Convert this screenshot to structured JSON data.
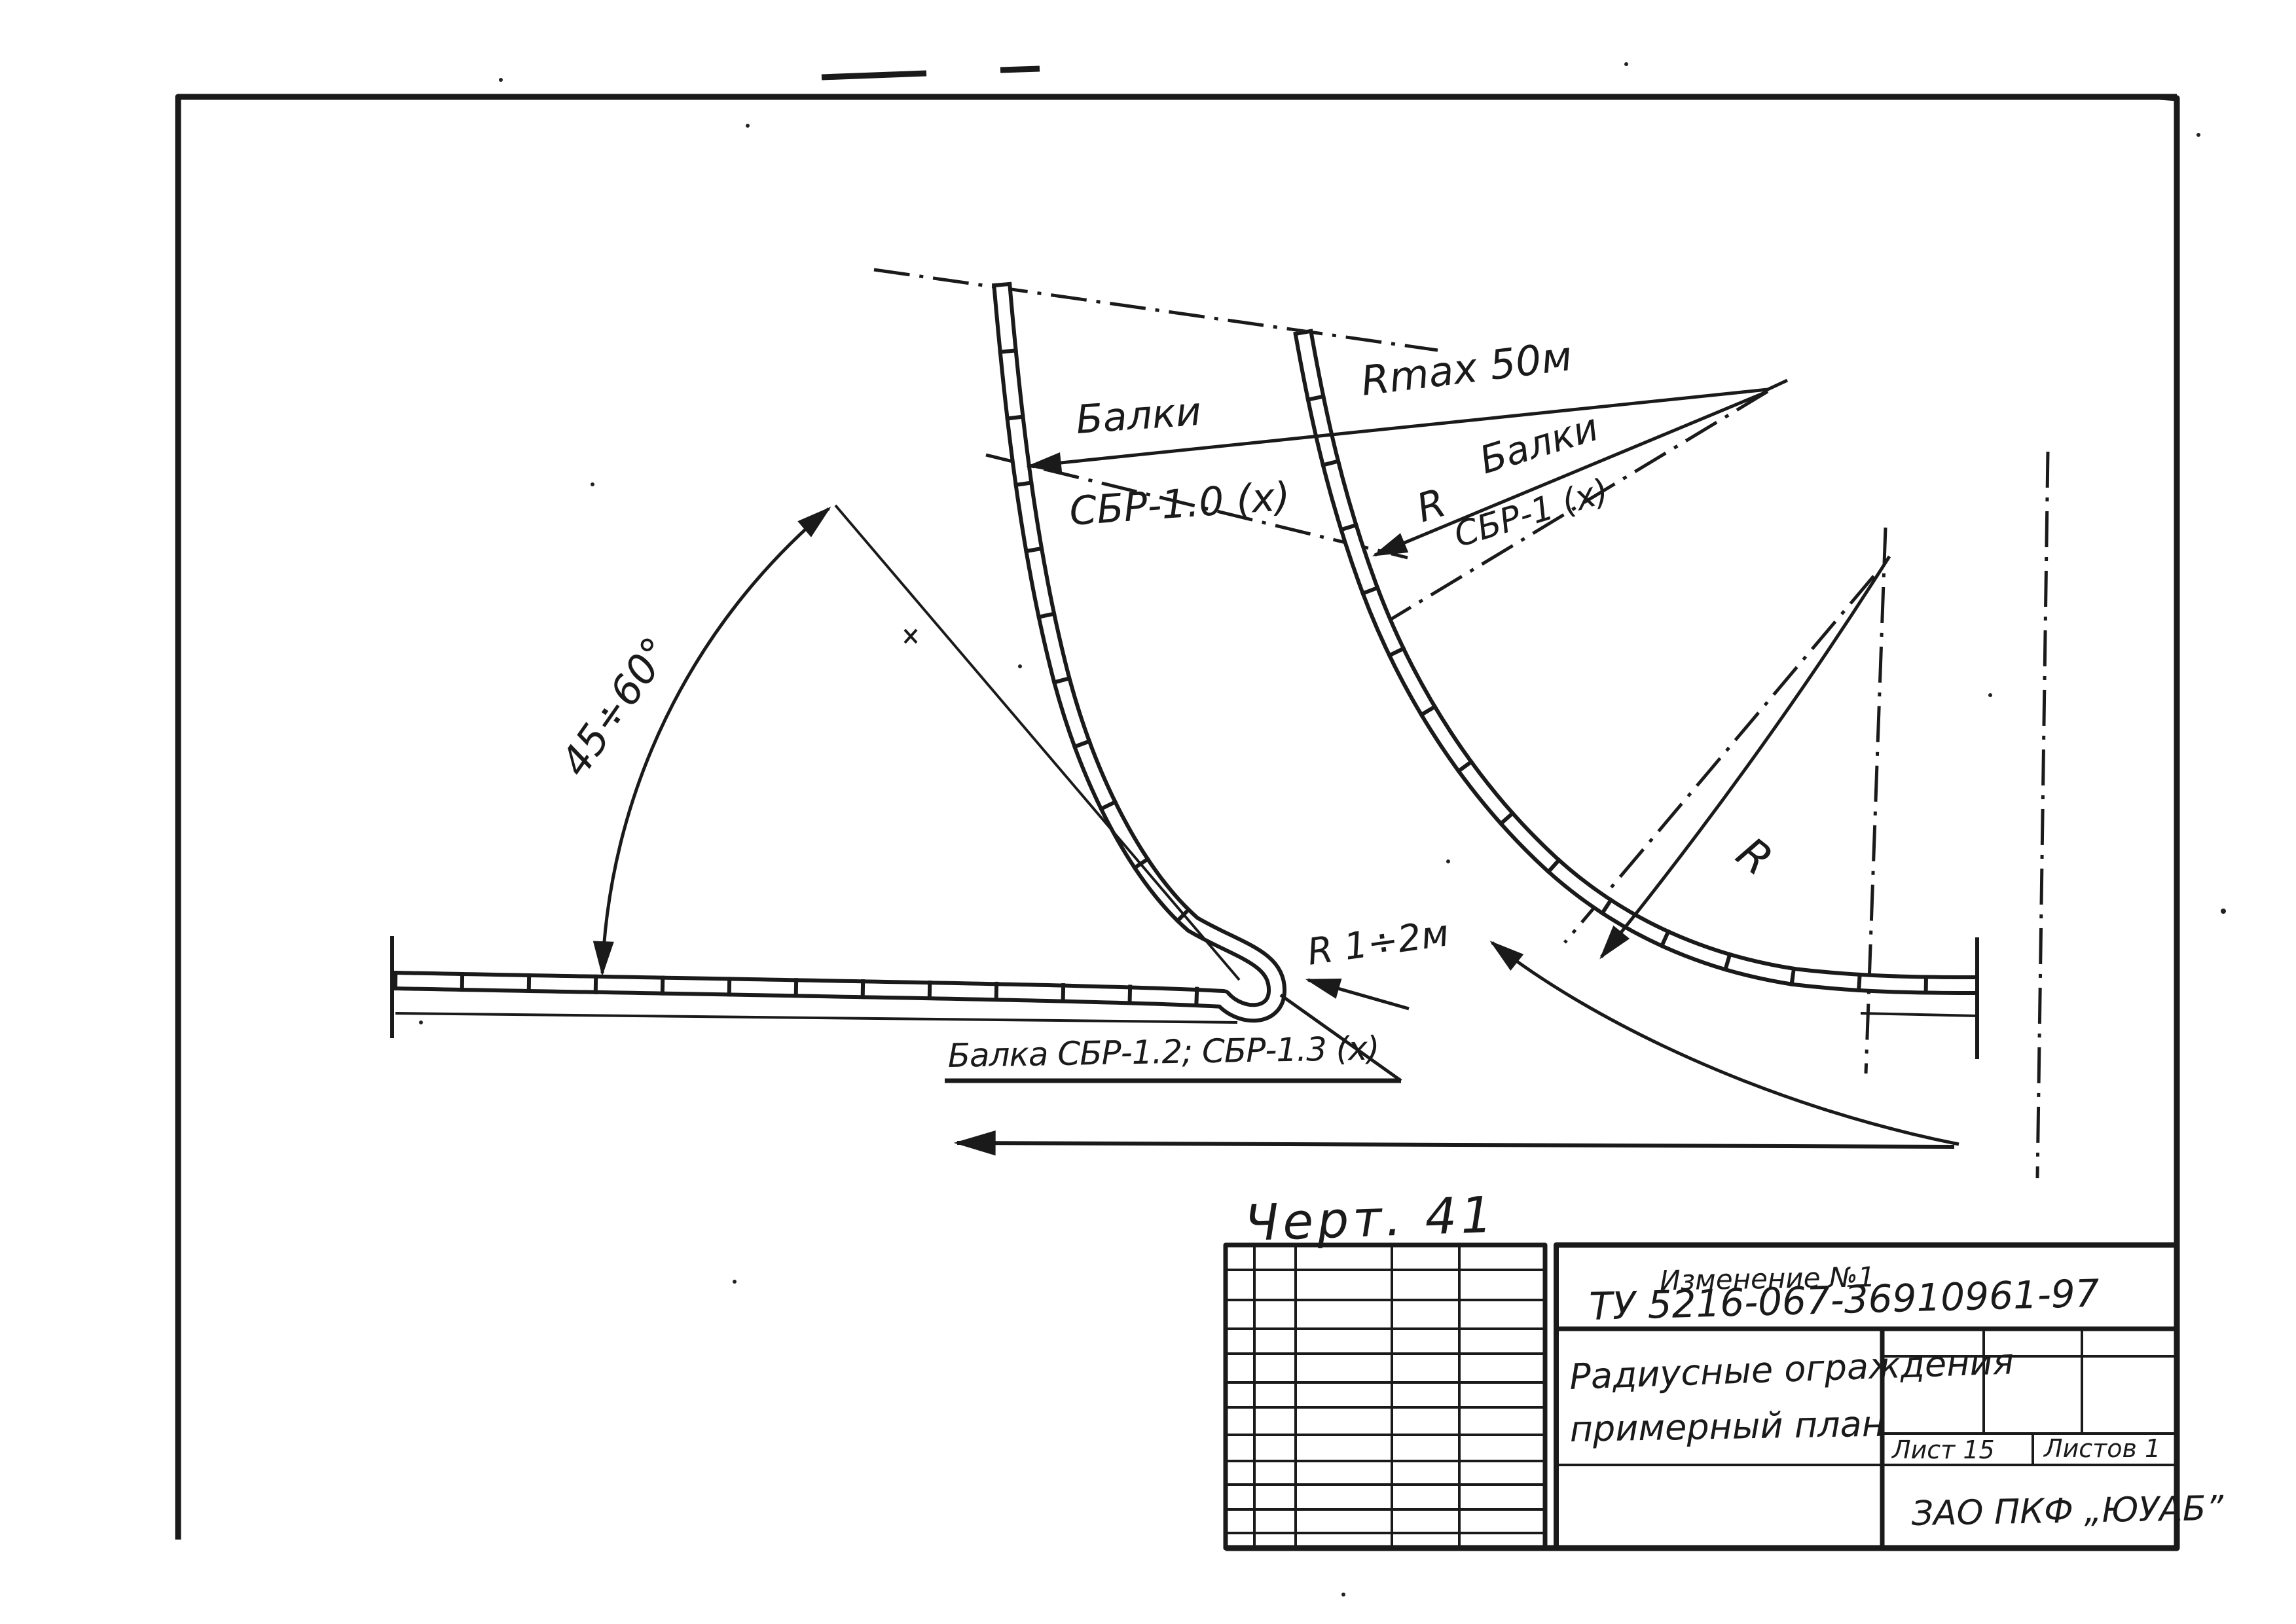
{
  "page": {
    "kind": "scanned engineering drawing",
    "language": "ru",
    "figure_caption": "Черт. 41"
  },
  "annotations": {
    "beams_top": {
      "line1": "Балки",
      "line2": "СБР-1.0 (х)"
    },
    "rmax": "Rmax 50м",
    "r_beams": {
      "r": "R",
      "word": "Балки",
      "code": "СБР-1 (х)"
    },
    "angle_range": "45÷60°",
    "radius_label": "R",
    "hook_radius": "R 1÷2м",
    "beams_bottom": "Балка СБР-1.2; СБР-1.3 (х)"
  },
  "title_block": {
    "revision_note": "Изменение №1",
    "spec_number": "ТУ 5216-067-36910961-97",
    "drawing_title_line1": "Радиусные ограждения",
    "drawing_title_line2": "примерный план",
    "sheet_label": "Лист 15",
    "sheets_total_label": "Листов 1",
    "company": "ЗАО ПКФ „ЮУАБ”"
  },
  "colors": {
    "ink": "#1a1a1a",
    "paper": "#ffffff"
  }
}
